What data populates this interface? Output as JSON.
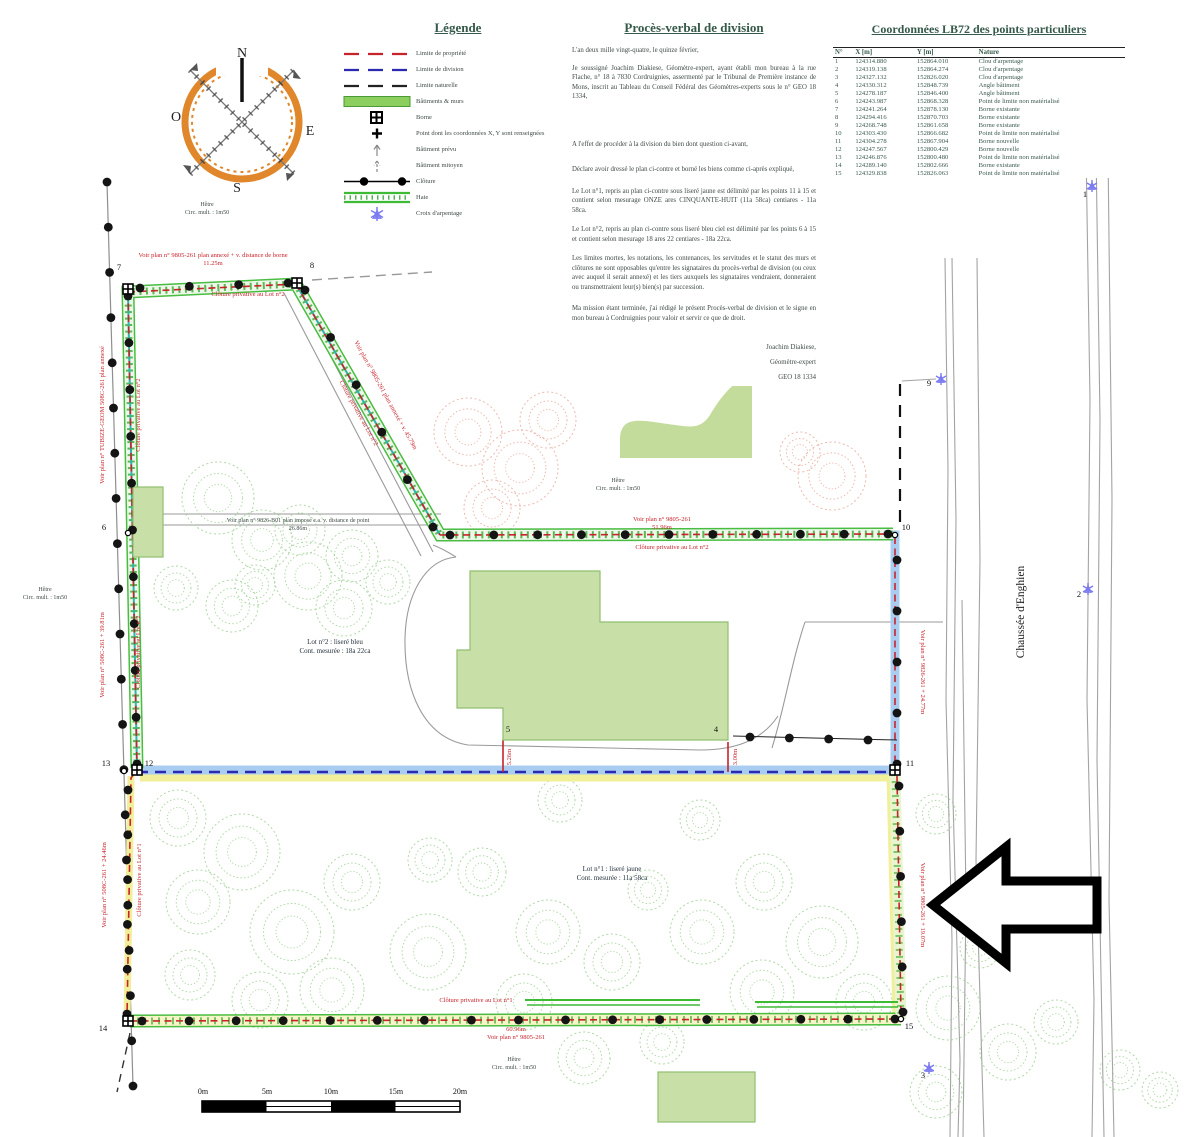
{
  "legend": {
    "title": "Légende",
    "items": [
      {
        "symbol": "prop-line",
        "label": "Limite de propriété"
      },
      {
        "symbol": "div-line",
        "label": "Limite de division"
      },
      {
        "symbol": "nat-line",
        "label": "Limite naturelle"
      },
      {
        "symbol": "building",
        "label": "Bâtiments & murs"
      },
      {
        "symbol": "borne",
        "label": "Borne"
      },
      {
        "symbol": "point-xy",
        "label": "Point dont les coordonnées X, Y sont renseignées"
      },
      {
        "symbol": "bat-prev",
        "label": "Bâtiment prévu"
      },
      {
        "symbol": "bat-mit",
        "label": "Bâtiment mitoyen"
      },
      {
        "symbol": "cloture",
        "label": "Clôture"
      },
      {
        "symbol": "haie",
        "label": "Haie"
      },
      {
        "symbol": "croix",
        "label": "Croix d'arpentage"
      }
    ]
  },
  "pv": {
    "title": "Procès-verbal de division",
    "paragraphs": [
      "L'an deux mille vingt-quatre, le quinze février,",
      "Je soussigné Joachim Diakiese, Géomètre-expert, ayant établi mon bureau à la rue Flache, n° 18 à 7830 Cordruignies, assermenté par le Tribunal de Première instance de Mons, inscrit au Tableau du Conseil Fédéral des Géomètres-experts sous le n° GEO 18 1334,",
      "A l'effet de procéder à la division du bien dont question ci-avant,",
      "Déclare avoir dressé le plan ci-contre et borné les biens comme ci-après expliqué,",
      "Le Lot n°1, repris au plan ci-contre sous liseré jaune est délimité par les points 11 à 15 et contient selon mesurage ONZE ares CINQUANTE-HUIT (11a 58ca) centiares - 11a 58ca.",
      "Le Lot n°2, repris au plan ci-contre sous liseré bleu ciel est délimité par les points 6 à 15 et contient selon mesurage 18 ares 22 centiares - 18a 22ca.",
      "Les limites mortes, les notations, les contenances, les servitudes et le statut des murs et clôtures ne sont opposables qu'entre les signataires du procès-verbal de division (ou ceux avec auquel il serait annexé) et les tiers auxquels les signataires vendraient, donneraient ou transmettraient leur(s) bien(s) par succession.",
      "Ma mission étant terminée, j'ai rédigé le présent Procès-verbal de division et le signe en mon bureau à Cordruignies pour valoir et servir ce que de droit."
    ],
    "signature": [
      "Joachim Diakiese,",
      "Géomètre-expert",
      "GEO 18 1334"
    ]
  },
  "coords": {
    "title": "Coordonnées LB72 des points particuliers",
    "columns": [
      "N°",
      "X [m]",
      "Y [m]",
      "Nature"
    ],
    "rows": [
      [
        "1",
        "124314.880",
        "152864.010",
        "Clou d'arpentage"
      ],
      [
        "2",
        "124319.138",
        "152864.274",
        "Clou d'arpentage"
      ],
      [
        "3",
        "124327.132",
        "152826.020",
        "Clou d'arpentage"
      ],
      [
        "4",
        "124330.312",
        "152848.739",
        "Angle bâtiment"
      ],
      [
        "5",
        "124278.187",
        "152846.400",
        "Angle bâtiment"
      ],
      [
        "6",
        "124243.987",
        "152868.328",
        "Point de limite non matérialisé"
      ],
      [
        "7",
        "124241.264",
        "152878.130",
        "Borne existante"
      ],
      [
        "8",
        "124294.416",
        "152870.703",
        "Borne existante"
      ],
      [
        "9",
        "124268.748",
        "152861.658",
        "Borne existante"
      ],
      [
        "10",
        "124303.430",
        "152866.682",
        "Point de limite non matérialisé"
      ],
      [
        "11",
        "124304.278",
        "152867.904",
        "Borne nouvelle"
      ],
      [
        "12",
        "124247.567",
        "152800.429",
        "Borne nouvelle"
      ],
      [
        "13",
        "124246.876",
        "152800.480",
        "Point de limite non matérialisé"
      ],
      [
        "14",
        "124289.140",
        "152802.666",
        "Borne existante"
      ],
      [
        "15",
        "124329.838",
        "152826.063",
        "Point de limite non matérialisé"
      ]
    ]
  },
  "plan": {
    "labels": [
      "Voir plan n° 9805-261 plan annexé + v. distance de borne",
      "11.25m",
      "Clôture privative au Lot n°2",
      "Voir plan n° 9805-261 plan annexé + v. 45.79m",
      "Clôture privative au Lot n°2",
      "Voir plan n° TUBIZE-GEOM 508C-261 plan annexé",
      "Clôture privative au Lot n°2",
      "Voir plan n° 508C-261 + 39.81m",
      "Clôture privative au Lot n°2",
      "Voir plan n° 508C-261 + 24.46m",
      "Clôture privative au Lot n°1",
      "Voir plan n° 9805-261",
      "51.96m",
      "Clôture privative au Lot n°2",
      "Voir plan n° 9826-261 + 24.77m",
      "Voir plan n° 9805-261 + 19.07m",
      "Clôture privative au Lot n°1",
      "60.96m",
      "Voir plan n° 9805-261",
      "Voir plan n° 9826-B01 plan imposé e.a. v. distance de point",
      "26.86m",
      "5.26m",
      "3.00m",
      "Lot n°2 : liseré bleu",
      "Cont. mesurée : 18a 22ca",
      "Lot n°1 : liseré jaune",
      "Cont. mesurée : 11a 58ca",
      "Chaussée d'Enghien",
      "0m",
      "5m",
      "10m",
      "15m",
      "20m",
      "Hêtre",
      "Circ. mult. : 1m50",
      "Hêtre",
      "Circ. mult. : 1m50",
      "Hêtre",
      "Circ. mult. : 1m50",
      "Hêtre",
      "Circ. mult. : 1m50",
      "7",
      "8",
      "6",
      "9",
      "10",
      "11",
      "12",
      "13",
      "5",
      "4",
      "14",
      "15",
      "1",
      "2",
      "3",
      "N",
      "O",
      "E",
      "S"
    ]
  },
  "colors": {
    "property_limit_red": "#c8232b",
    "division_limit_blue": "#2a2ab0",
    "lot2_band_blue": "#a9cdf1",
    "lot1_band_yellow": "#f2ef9a",
    "hedge_green": "#49bd41",
    "building_green": "#c8e0a8",
    "compass_orange": "#e1872b",
    "survey_cross_blue": "#7b7bf0"
  }
}
